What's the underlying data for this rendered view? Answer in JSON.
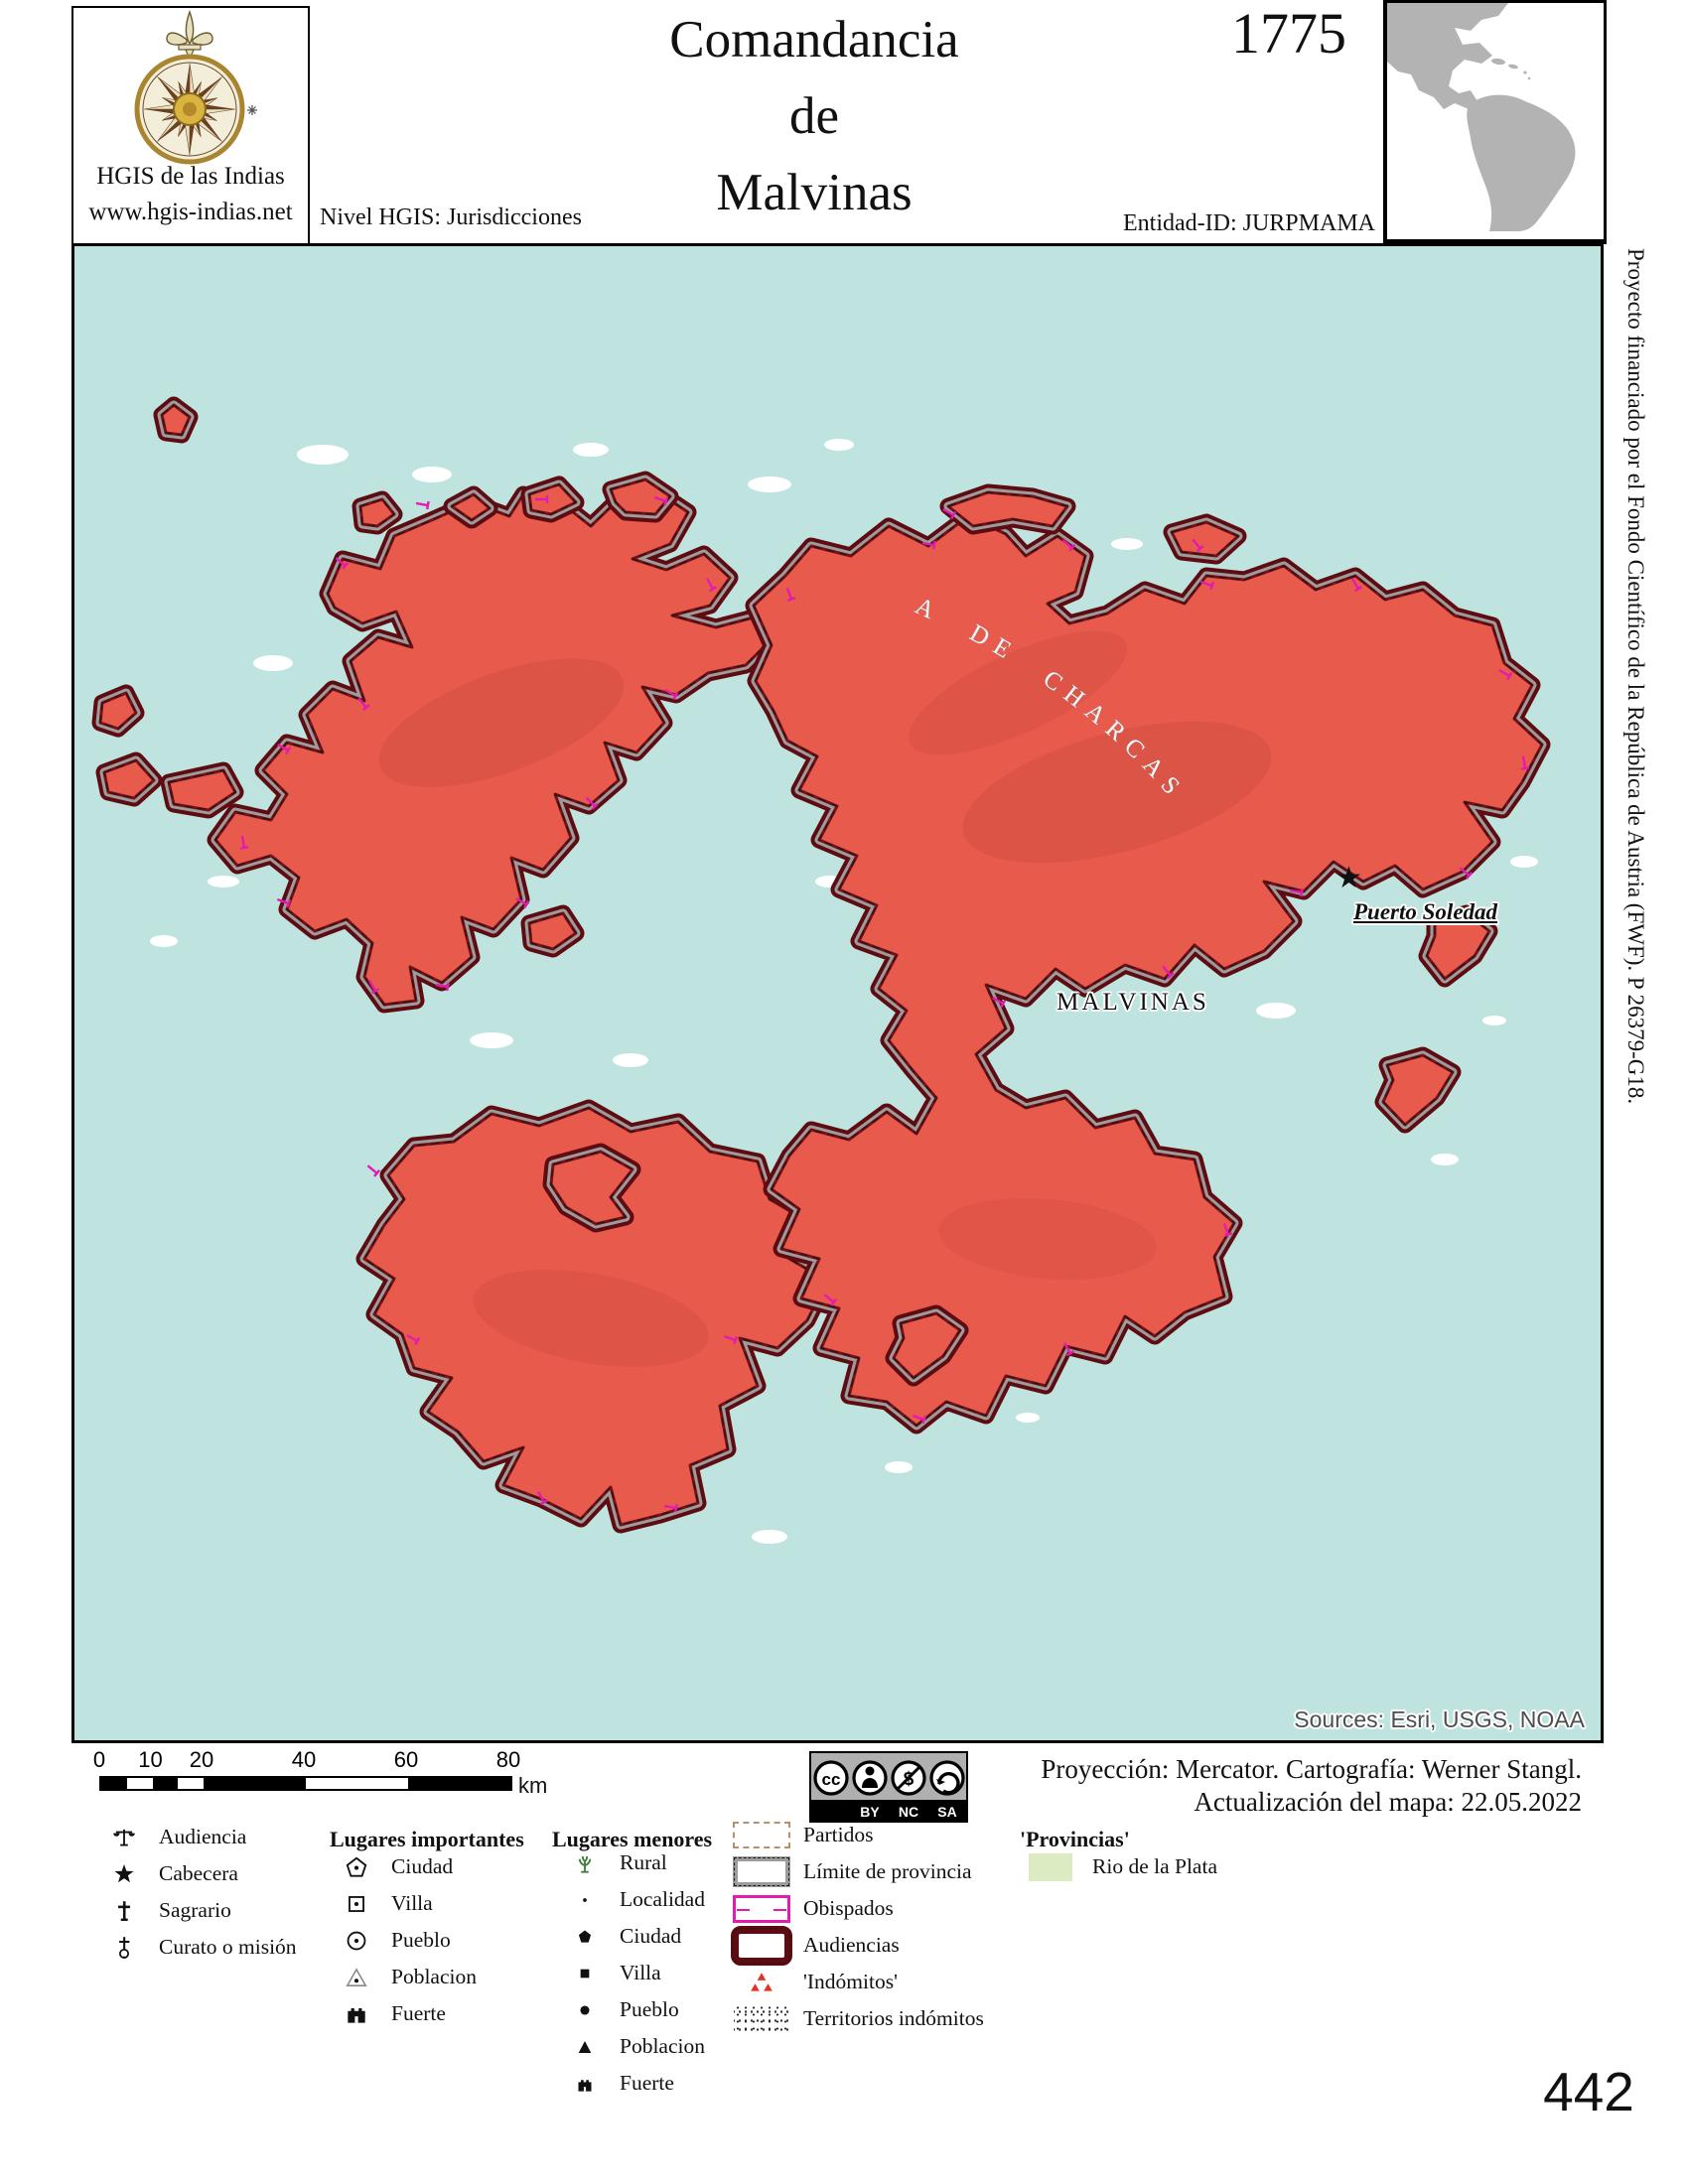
{
  "header": {
    "logo_title": "HGIS de las Indias",
    "logo_url": "www.hgis-indias.net",
    "level_label": "Nivel HGIS: Jurisdicciones",
    "title_line1": "Comandancia",
    "title_line2": "de",
    "title_line3": "Malvinas",
    "year": "1775",
    "entity_id": "Entidad-ID: JURPMAMA"
  },
  "side_note": "Proyecto financiado por el Fondo Científico de la República de Austria (FWF).  P 26379-G18.",
  "map": {
    "label_malvinas": "MALVINAS",
    "star_glyph": "★",
    "label_puerto_soledad": "Puerto Soledad",
    "label_audiencia_arc": "A DE CHARCAS",
    "sources_credit": "Sources: Esri, USGS, NOAA"
  },
  "scalebar": {
    "ticks": [
      "0",
      "10",
      "20",
      "40",
      "60",
      "80"
    ],
    "unit": "km"
  },
  "license": {
    "icons": [
      "cc-icon",
      "attribution-icon",
      "non-commercial-icon",
      "share-alike-icon"
    ],
    "labels": [
      "BY",
      "NC",
      "SA"
    ]
  },
  "credits": {
    "line1": "Proyección: Mercator. Cartografía: Werner Stangl.",
    "line2": "Actualización del mapa: 22.05.2022"
  },
  "legend": {
    "general": [
      {
        "icon": "scales",
        "label": "Audiencia"
      },
      {
        "icon": "star",
        "label": "Cabecera"
      },
      {
        "icon": "cross",
        "label": "Sagrario"
      },
      {
        "icon": "mission",
        "label": "Curato o misión"
      }
    ],
    "important_header": "Lugares importantes",
    "important": [
      {
        "icon": "pentagon-dot",
        "label": "Ciudad"
      },
      {
        "icon": "square-dot",
        "label": "Villa"
      },
      {
        "icon": "circle-dot",
        "label": "Pueblo"
      },
      {
        "icon": "triangle-dot",
        "label": "Poblacion"
      },
      {
        "icon": "castle",
        "label": "Fuerte"
      }
    ],
    "minor_header": "Lugares menores",
    "minor": [
      {
        "icon": "rural",
        "label": "Rural"
      },
      {
        "icon": "dot",
        "label": "Localidad"
      },
      {
        "icon": "pentagon-fill",
        "label": "Ciudad"
      },
      {
        "icon": "square-fill",
        "label": "Villa"
      },
      {
        "icon": "circle-fill",
        "label": "Pueblo"
      },
      {
        "icon": "triangle-fill",
        "label": "Poblacion"
      },
      {
        "icon": "castle-small",
        "label": "Fuerte"
      }
    ],
    "boundaries": [
      {
        "swatch": "partidos",
        "label": "Partidos"
      },
      {
        "swatch": "provincia",
        "label": "Límite de provincia"
      },
      {
        "swatch": "obispados",
        "label": "Obispados"
      },
      {
        "swatch": "audiencias",
        "label": "Audiencias"
      },
      {
        "swatch": "indomitos",
        "label": "'Indómitos'"
      },
      {
        "swatch": "territorios",
        "label": "Territorios indómitos"
      }
    ],
    "provincias_header": "'Provincias'",
    "provincias": [
      {
        "swatch": "rio",
        "label": "Rio de la Plata"
      }
    ]
  },
  "page_number": "442",
  "colors": {
    "sea": "#bfe4df",
    "land": "#e85a4b",
    "border_maroon": "#5e0c12",
    "border_gray": "#9c9c9c",
    "obispados_magenta": "#e31bb1",
    "partidos_tan": "#b5906b",
    "provincias_green": "#dcebc2",
    "indomitos_red": "#e53228",
    "inset_gray": "#b3b3b3"
  }
}
